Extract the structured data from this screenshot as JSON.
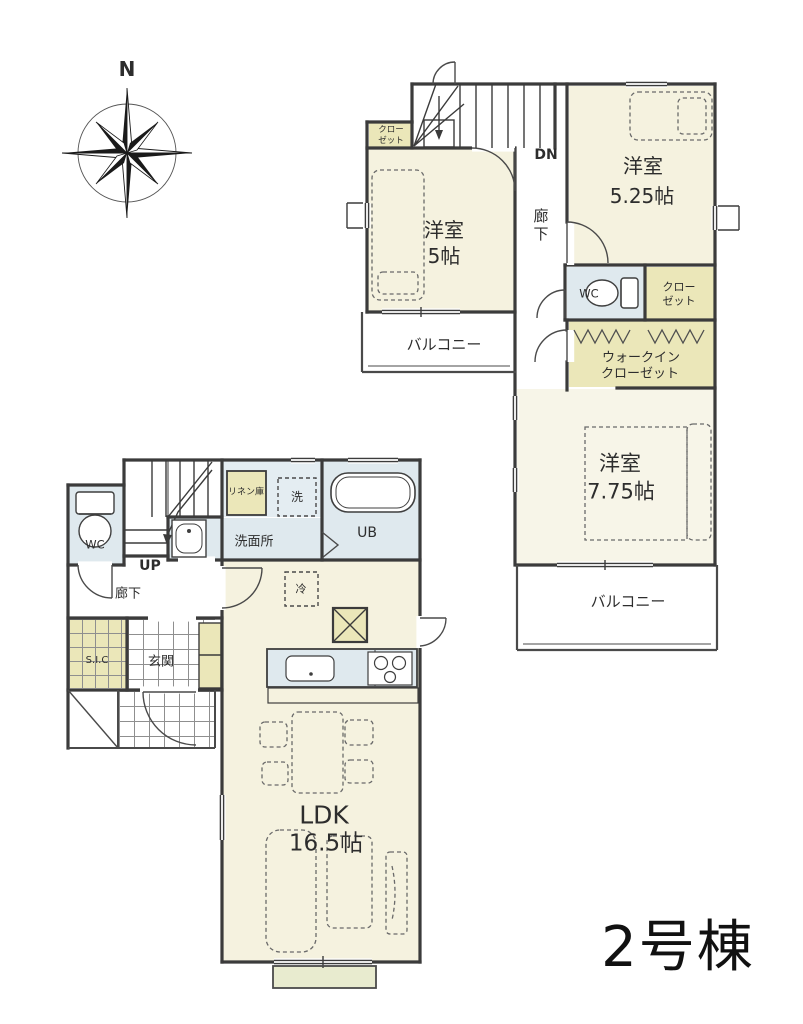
{
  "title": "2号棟",
  "compass": {
    "north_label": "N"
  },
  "colors": {
    "wall": "#3b3b3b",
    "room_cream": "#f5f2df",
    "accent_yellow": "#ebe7b9",
    "water_blue": "#dfe9ee",
    "terrace_green": "#e8ebcf"
  },
  "floor2": {
    "closet_nw": {
      "line1": "クロー",
      "line2": "ゼット"
    },
    "stairs_label": "DN",
    "room_5": {
      "line1": "洋室",
      "line2": "5帖"
    },
    "hallway_label": "廊下",
    "room_5_25": {
      "line1": "洋室",
      "line2": "5.25帖"
    },
    "wc_label": "WC",
    "closet_e": {
      "line1": "クロー",
      "line2": "ゼット"
    },
    "walk_in_closet": {
      "line1": "ウォークイン",
      "line2": "クローゼット"
    },
    "balcony_west_label": "バルコニー",
    "room_7_75": {
      "line1": "洋室",
      "line2": "7.75帖"
    },
    "balcony_south_label": "バルコニー"
  },
  "floor1": {
    "wc_label": "WC",
    "stairs_label": "UP",
    "linen_label": "リネン庫",
    "washer_label": "洗",
    "unit_bath_label": "UB",
    "lavatory_label": "洗面所",
    "hallway_label": "廊下",
    "fridge_label": "冷",
    "shoe_closet_label": "S.I.C",
    "entrance_label": "玄関",
    "ldk": {
      "line1": "LDK",
      "line2": "16.5帖"
    }
  }
}
